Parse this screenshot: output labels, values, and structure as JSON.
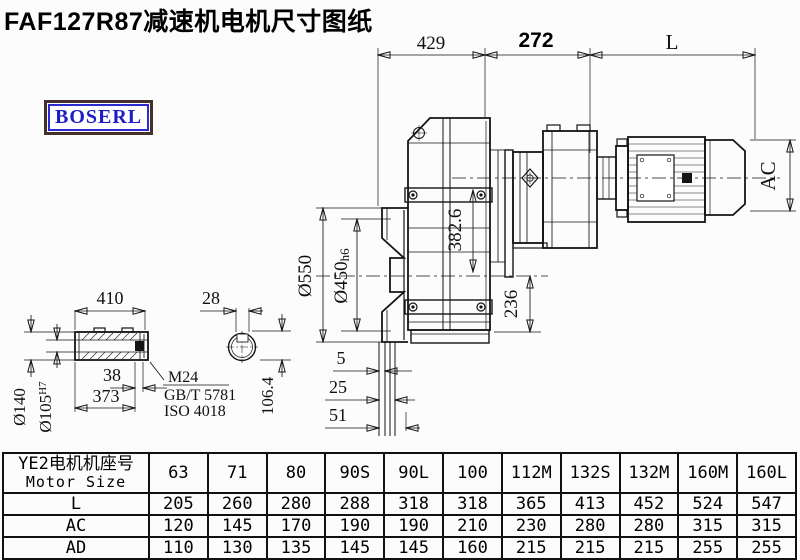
{
  "page": {
    "title": "FAF127R87减速机电机尺寸图纸",
    "logo": "BOSERL"
  },
  "drawing": {
    "top_dims": {
      "d429": "429",
      "d272": "272",
      "dL": "L"
    },
    "left_dims": {
      "d550": "Ø550",
      "d450": "Ø450",
      "d450_tol": "h6"
    },
    "inner_dims": {
      "d382": "382.6",
      "d236": "236"
    },
    "bottom_dims": {
      "d5": "5",
      "d25": "25",
      "d51": "51"
    },
    "right_dims": {
      "ac": "AC"
    },
    "shaft_detail": {
      "d410": "410",
      "d28": "28",
      "d140": "Ø140",
      "d105": "Ø105",
      "d105_tol": "H7",
      "d38": "38",
      "d373": "373",
      "thread": "M24",
      "std_gb": "GB/T 5781",
      "std_iso": "ISO 4018",
      "d106": "106.4"
    }
  },
  "table": {
    "header_cn": "YE2电机机座号",
    "header_en": "Motor Size",
    "columns": [
      "63",
      "71",
      "80",
      "90S",
      "90L",
      "100",
      "112M",
      "132S",
      "132M",
      "160M",
      "160L"
    ],
    "rows": [
      {
        "label": "L",
        "values": [
          "205",
          "260",
          "280",
          "288",
          "318",
          "318",
          "365",
          "413",
          "452",
          "524",
          "547"
        ]
      },
      {
        "label": "AC",
        "values": [
          "120",
          "145",
          "170",
          "190",
          "190",
          "210",
          "230",
          "280",
          "280",
          "315",
          "315"
        ]
      },
      {
        "label": "AD",
        "values": [
          "110",
          "130",
          "135",
          "145",
          "145",
          "160",
          "215",
          "215",
          "215",
          "255",
          "255"
        ]
      }
    ]
  }
}
